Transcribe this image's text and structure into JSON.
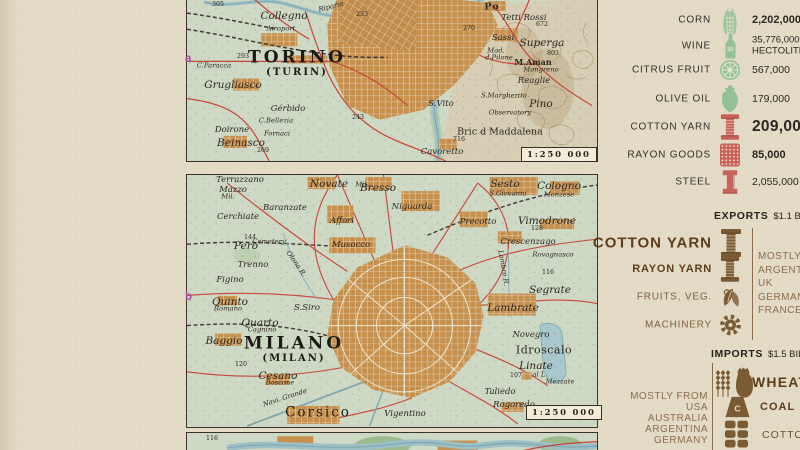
{
  "sidebar": {
    "stats": [
      {
        "label": "CORN",
        "icon": "corn",
        "color": "green",
        "value": "2,202,000",
        "emph": "bold"
      },
      {
        "label": "WINE",
        "icon": "wine",
        "color": "green",
        "value": "35,776,000",
        "value2": "HECTOLITERS",
        "emph": "twoline"
      },
      {
        "label": "CITRUS FRUIT",
        "icon": "citrus",
        "color": "green",
        "value": "567,000",
        "emph": "normal"
      },
      {
        "label": "OLIVE OIL",
        "icon": "oliveoil",
        "color": "green",
        "value": "179,000",
        "emph": "normal"
      },
      {
        "label": "COTTON YARN",
        "icon": "spool",
        "color": "red",
        "value": "209,000",
        "emph": "big"
      },
      {
        "label": "RAYON GOODS",
        "icon": "rayon",
        "color": "red",
        "value": "85,000",
        "emph": "bold"
      },
      {
        "label": "STEEL",
        "icon": "steel",
        "color": "red",
        "value": "2,055,000",
        "emph": "normal"
      }
    ],
    "exports": {
      "title": "EXPORTS",
      "amount": "$1.1 BILL.",
      "items": [
        {
          "label": "COTTON YARN",
          "icon": "spool",
          "size": "big"
        },
        {
          "label": "RAYON YARN",
          "icon": "spool",
          "size": "med"
        },
        {
          "label": "FRUITS, VEG.",
          "icon": "fruits",
          "size": "small"
        },
        {
          "label": "MACHINERY",
          "icon": "gear",
          "size": "small"
        }
      ],
      "destinations": [
        "MOSTLY TO",
        "ARGENTINA",
        "UK",
        "GERMANY",
        "FRANCE"
      ]
    },
    "imports": {
      "title": "IMPORTS",
      "amount": "$1.5 BILL.",
      "origins": [
        "MOSTLY FROM",
        "USA",
        "AUSTRALIA",
        "ARGENTINA",
        "GERMANY"
      ],
      "items": [
        {
          "label": "WHEAT",
          "icon": "wheatsack",
          "size": "big"
        },
        {
          "label": "COAL",
          "icon": "coal",
          "icon_letter": "C",
          "size": "med"
        },
        {
          "label": "COTTON",
          "icon": "bales",
          "size": "small"
        }
      ]
    },
    "colors": {
      "green": "#92c197",
      "red": "#c9625a",
      "brown": "#7b5b33"
    }
  },
  "maps": {
    "margin_letters": [
      {
        "text": "a"
      },
      {
        "text": "b"
      }
    ],
    "torino": {
      "scale": "1:250 000",
      "labels": [
        {
          "t": "305",
          "x": 218,
          "y": 5,
          "c": "num"
        },
        {
          "t": "Riparia",
          "x": 331,
          "y": 7,
          "c": "town-sm",
          "r": -14
        },
        {
          "t": "Collegno",
          "x": 284,
          "y": 16,
          "c": "town-lg"
        },
        {
          "t": "Airoport",
          "x": 281,
          "y": 29,
          "c": "town-sm"
        },
        {
          "t": "233",
          "x": 362,
          "y": 15,
          "c": "num"
        },
        {
          "t": "Po",
          "x": 492,
          "y": 7,
          "c": "river-bold"
        },
        {
          "t": "Tetti Rossi",
          "x": 524,
          "y": 18,
          "c": "town"
        },
        {
          "t": "672",
          "x": 542,
          "y": 25,
          "c": "num"
        },
        {
          "t": "270",
          "x": 469,
          "y": 29,
          "c": "num"
        },
        {
          "t": "Sassi",
          "x": 503,
          "y": 38,
          "c": "town"
        },
        {
          "t": "Superga",
          "x": 542,
          "y": 43,
          "c": "town-lg"
        },
        {
          "t": "Mad.",
          "x": 496,
          "y": 51,
          "c": "town-sm"
        },
        {
          "t": "d.Pilone",
          "x": 499,
          "y": 58,
          "c": "town-sm"
        },
        {
          "t": "803",
          "x": 553,
          "y": 54,
          "c": "num"
        },
        {
          "t": "M.Aman",
          "x": 533,
          "y": 62,
          "c": "upright-sm"
        },
        {
          "t": "Mongreno",
          "x": 541,
          "y": 70,
          "c": "town-sm"
        },
        {
          "t": "Reaglie",
          "x": 534,
          "y": 81,
          "c": "town"
        },
        {
          "t": "293",
          "x": 243,
          "y": 57,
          "c": "num"
        },
        {
          "t": "TORINO",
          "x": 297,
          "y": 58,
          "c": "city-big"
        },
        {
          "t": "(TURIN)",
          "x": 297,
          "y": 73,
          "c": "city-sub"
        },
        {
          "t": "C.Paracca",
          "x": 214,
          "y": 66,
          "c": "town-sm"
        },
        {
          "t": "Grugliasco",
          "x": 233,
          "y": 85,
          "c": "town-lg"
        },
        {
          "t": "Gérbido",
          "x": 288,
          "y": 109,
          "c": "town"
        },
        {
          "t": "C.Bellezia",
          "x": 276,
          "y": 121,
          "c": "town-sm"
        },
        {
          "t": "Doirone",
          "x": 232,
          "y": 130,
          "c": "town"
        },
        {
          "t": "Fornaci",
          "x": 277,
          "y": 134,
          "c": "town-sm"
        },
        {
          "t": "Beinasco",
          "x": 241,
          "y": 143,
          "c": "town-lg"
        },
        {
          "t": "269",
          "x": 263,
          "y": 151,
          "c": "num"
        },
        {
          "t": "243",
          "x": 358,
          "y": 118,
          "c": "num"
        },
        {
          "t": "S.Margherita",
          "x": 504,
          "y": 96,
          "c": "town-sm"
        },
        {
          "t": "Pino",
          "x": 541,
          "y": 104,
          "c": "town-lg"
        },
        {
          "t": "S.Vito",
          "x": 441,
          "y": 104,
          "c": "town"
        },
        {
          "t": "Observatory",
          "x": 510,
          "y": 113,
          "c": "town-sm"
        },
        {
          "t": "Bric d Maddalena",
          "x": 500,
          "y": 132,
          "c": "upright"
        },
        {
          "t": "716",
          "x": 459,
          "y": 140,
          "c": "num"
        },
        {
          "t": "Cavoretto",
          "x": 442,
          "y": 152,
          "c": "town"
        }
      ]
    },
    "milano": {
      "scale": "1:250 000",
      "labels": [
        {
          "t": "Terrazzano",
          "x": 240,
          "y": 180,
          "c": "town"
        },
        {
          "t": "Mazzo",
          "x": 233,
          "y": 190,
          "c": "town"
        },
        {
          "t": "Mil.",
          "x": 228,
          "y": 197,
          "c": "town-sm"
        },
        {
          "t": "Novate",
          "x": 329,
          "y": 184,
          "c": "town-lg"
        },
        {
          "t": "Mil.",
          "x": 362,
          "y": 185,
          "c": "town-sm"
        },
        {
          "t": "Bresso",
          "x": 378,
          "y": 188,
          "c": "town-lg"
        },
        {
          "t": "Baranzate",
          "x": 285,
          "y": 208,
          "c": "town"
        },
        {
          "t": "Cerchiate",
          "x": 238,
          "y": 217,
          "c": "town"
        },
        {
          "t": "Affori",
          "x": 342,
          "y": 221,
          "c": "town"
        },
        {
          "t": "Niguarda",
          "x": 412,
          "y": 207,
          "c": "town"
        },
        {
          "t": "144",
          "x": 250,
          "y": 238,
          "c": "num"
        },
        {
          "t": "Cemetery",
          "x": 269,
          "y": 242,
          "c": "town-sm"
        },
        {
          "t": "Pero",
          "x": 246,
          "y": 246,
          "c": "town-lg"
        },
        {
          "t": "Musocco",
          "x": 351,
          "y": 245,
          "c": "town"
        },
        {
          "t": "Trenno",
          "x": 253,
          "y": 265,
          "c": "town"
        },
        {
          "t": "Olona R.",
          "x": 296,
          "y": 264,
          "c": "town-sm",
          "r": 55
        },
        {
          "t": "Figino",
          "x": 230,
          "y": 280,
          "c": "town"
        },
        {
          "t": "Sesto",
          "x": 505,
          "y": 184,
          "c": "town-lg"
        },
        {
          "t": "S.Giovanni",
          "x": 508,
          "y": 194,
          "c": "town-sm"
        },
        {
          "t": "Cologno",
          "x": 559,
          "y": 186,
          "c": "town-lg"
        },
        {
          "t": "Monzese",
          "x": 559,
          "y": 195,
          "c": "town-sm"
        },
        {
          "t": "Precotto",
          "x": 478,
          "y": 222,
          "c": "town"
        },
        {
          "t": "Vimodrone",
          "x": 547,
          "y": 221,
          "c": "town-lg"
        },
        {
          "t": "128",
          "x": 537,
          "y": 229,
          "c": "num"
        },
        {
          "t": "Crescenzago",
          "x": 528,
          "y": 242,
          "c": "town"
        },
        {
          "t": "Rovagnasco",
          "x": 553,
          "y": 255,
          "c": "town-sm"
        },
        {
          "t": "Lambro R.",
          "x": 503,
          "y": 268,
          "c": "town-sm",
          "r": 80
        },
        {
          "t": "116",
          "x": 548,
          "y": 273,
          "c": "num"
        },
        {
          "t": "Quinto",
          "x": 230,
          "y": 302,
          "c": "town-lg"
        },
        {
          "t": "Romano",
          "x": 228,
          "y": 309,
          "c": "town-sm"
        },
        {
          "t": "S.Siro",
          "x": 307,
          "y": 308,
          "c": "town"
        },
        {
          "t": "Quarto",
          "x": 260,
          "y": 323,
          "c": "town-lg"
        },
        {
          "t": "Cagnino",
          "x": 262,
          "y": 330,
          "c": "town-sm"
        },
        {
          "t": "Baggio",
          "x": 224,
          "y": 341,
          "c": "town-lg"
        },
        {
          "t": "MILANO",
          "x": 294,
          "y": 344,
          "c": "city-big"
        },
        {
          "t": "(MILAN)",
          "x": 294,
          "y": 359,
          "c": "city-sub"
        },
        {
          "t": "120",
          "x": 241,
          "y": 365,
          "c": "num"
        },
        {
          "t": "Cesano",
          "x": 278,
          "y": 376,
          "c": "town-lg"
        },
        {
          "t": "Boscone",
          "x": 280,
          "y": 383,
          "c": "town-sm"
        },
        {
          "t": "Navi. Grande",
          "x": 285,
          "y": 398,
          "c": "town-sm",
          "r": -18
        },
        {
          "t": "Corsico",
          "x": 318,
          "y": 413,
          "c": "city-mid"
        },
        {
          "t": "Segrate",
          "x": 550,
          "y": 290,
          "c": "town-lg"
        },
        {
          "t": "Lambrate",
          "x": 513,
          "y": 308,
          "c": "town-lg"
        },
        {
          "t": "Novegro",
          "x": 531,
          "y": 335,
          "c": "town"
        },
        {
          "t": "Idroscalo",
          "x": 544,
          "y": 350,
          "c": "upright-lg"
        },
        {
          "t": "Linate",
          "x": 536,
          "y": 366,
          "c": "town-lg"
        },
        {
          "t": "107",
          "x": 516,
          "y": 376,
          "c": "num"
        },
        {
          "t": "al L.",
          "x": 540,
          "y": 375,
          "c": "town-sm"
        },
        {
          "t": "Mezzate",
          "x": 560,
          "y": 382,
          "c": "town-sm"
        },
        {
          "t": "Taliedo",
          "x": 500,
          "y": 392,
          "c": "town"
        },
        {
          "t": "Rogoredo",
          "x": 514,
          "y": 405,
          "c": "town"
        },
        {
          "t": "Vigentino",
          "x": 405,
          "y": 414,
          "c": "town"
        }
      ]
    },
    "extra": {
      "labels": [
        {
          "t": "116",
          "x": 212,
          "y": 439,
          "c": "num"
        }
      ]
    }
  }
}
